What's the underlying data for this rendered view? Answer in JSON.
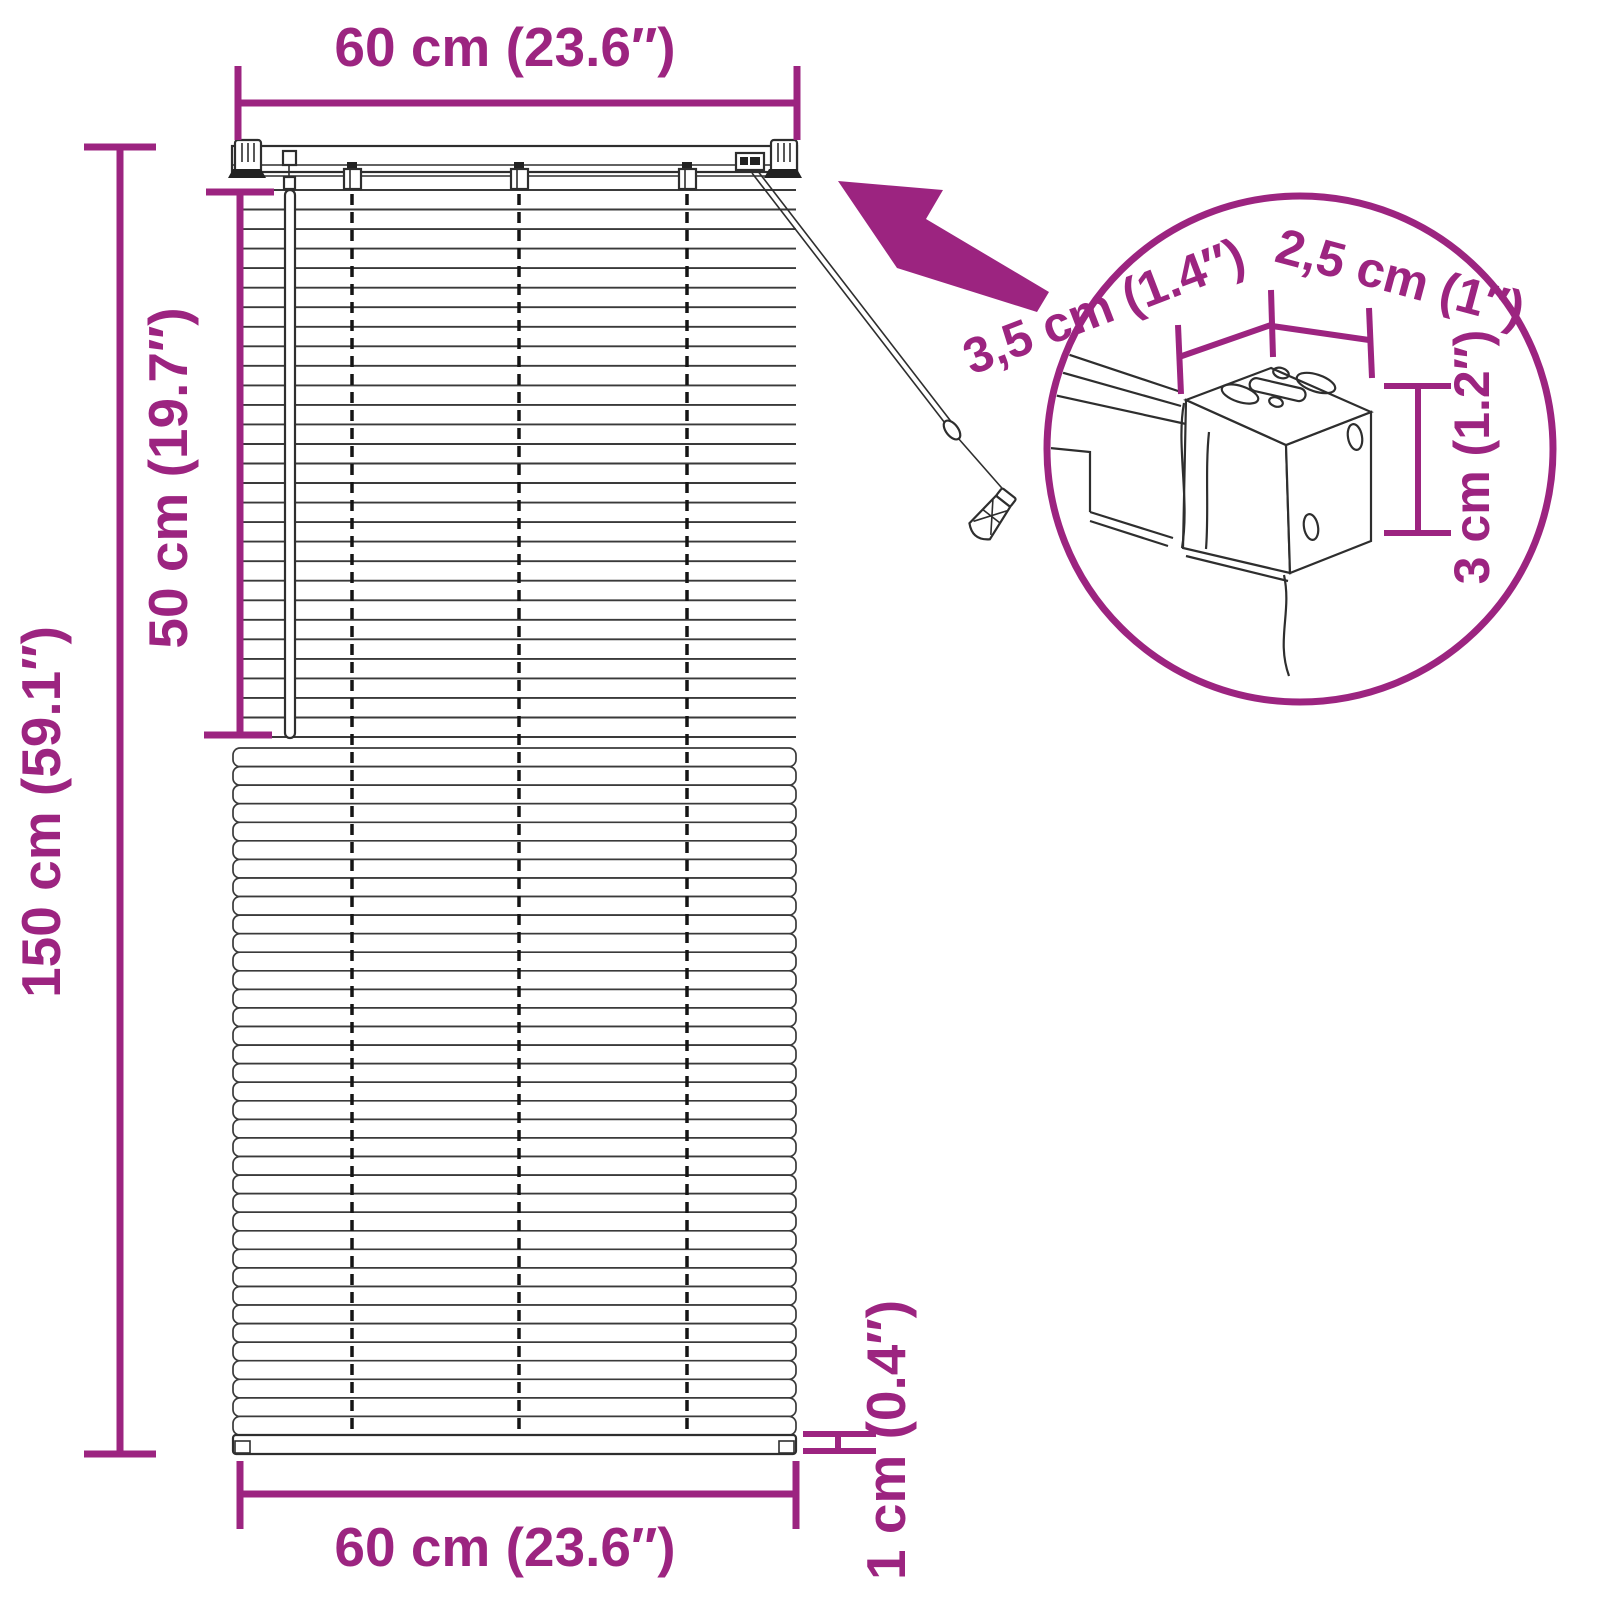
{
  "title": "Venetian blind dimension diagram",
  "colors": {
    "accent": "#9C2480",
    "drawing_line": "#2e2e2e",
    "background": "#ffffff"
  },
  "labels": {
    "top_width": "60 cm (23.6″)",
    "total_height": "150 cm (59.1″)",
    "drop_section": "50 cm (19.7″)",
    "bottom_width": "60 cm (23.6″)",
    "bottom_rail": "1 cm (0.4″)",
    "bracket_depth": "3,5 cm (1.4″)",
    "bracket_width": "2,5 cm (1″)",
    "bracket_height": "3 cm (1.2″)"
  },
  "measurements": [
    {
      "name": "blind width (top)",
      "metric": "60 cm",
      "imperial": "23.6″"
    },
    {
      "name": "total drop height",
      "metric": "150 cm",
      "imperial": "59.1″"
    },
    {
      "name": "raised section height",
      "metric": "50 cm",
      "imperial": "19.7″"
    },
    {
      "name": "blind width (bottom)",
      "metric": "60 cm",
      "imperial": "23.6″"
    },
    {
      "name": "bottom rail thickness",
      "metric": "1 cm",
      "imperial": "0.4″"
    },
    {
      "name": "headrail depth",
      "metric": "3,5 cm",
      "imperial": "1.4″"
    },
    {
      "name": "bracket width",
      "metric": "2,5 cm",
      "imperial": "1″"
    },
    {
      "name": "bracket height",
      "metric": "3 cm",
      "imperial": "1.2″"
    }
  ]
}
